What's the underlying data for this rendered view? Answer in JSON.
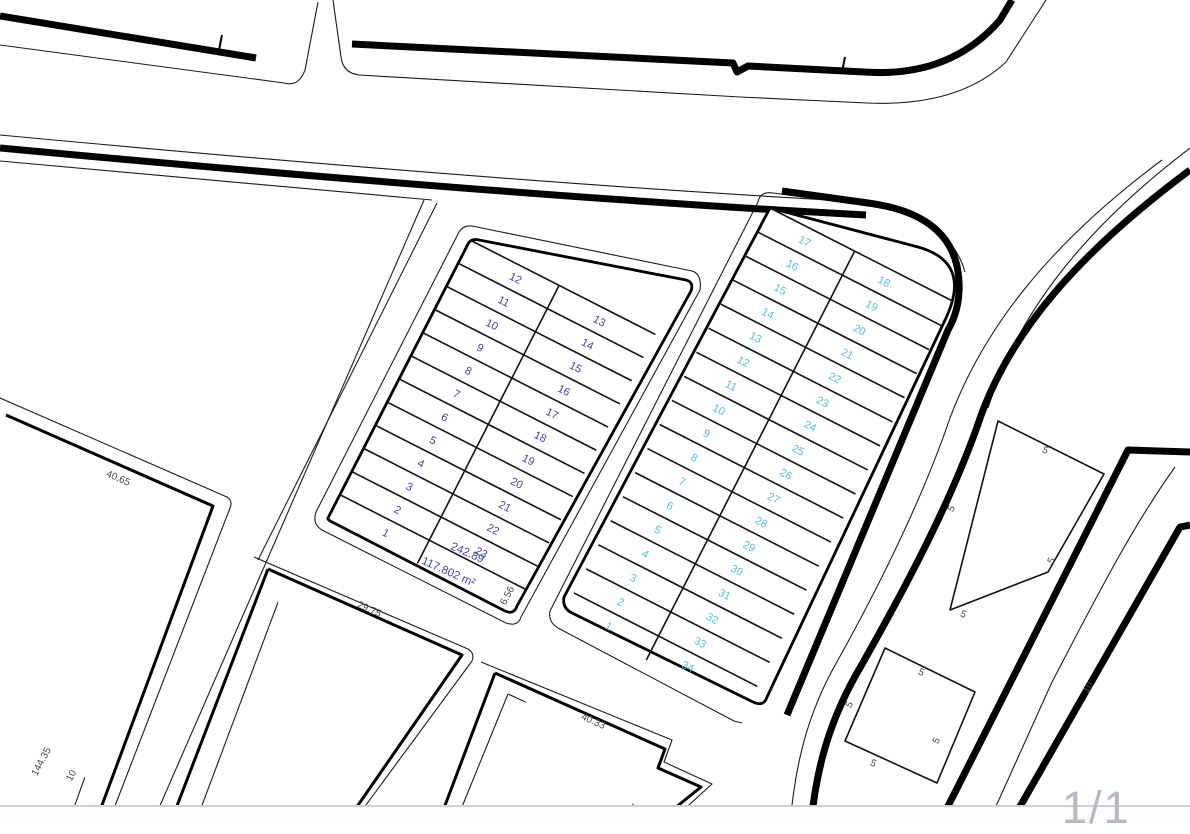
{
  "page_indicator": "1/1",
  "colors": {
    "left_parcels": "#3f43ad",
    "right_parcels": "#4cc3dc",
    "dimensions": "#4a4a4a",
    "page_indicator": "#b5bac1",
    "lines": "#000000"
  },
  "left_block": {
    "parcels": [
      "1",
      "2",
      "3",
      "4",
      "5",
      "6",
      "7",
      "8",
      "9",
      "10",
      "11",
      "12",
      "13",
      "14",
      "15",
      "16",
      "17",
      "18",
      "19",
      "20",
      "21",
      "22",
      "23"
    ],
    "dim_242": "242.89",
    "area_label": "117.802 m²"
  },
  "right_block": {
    "parcels": [
      "1",
      "2",
      "3",
      "4",
      "5",
      "6",
      "7",
      "8",
      "9",
      "10",
      "11",
      "12",
      "13",
      "14",
      "15",
      "16",
      "17",
      "18",
      "19",
      "20",
      "21",
      "22",
      "23",
      "24",
      "25",
      "26",
      "27",
      "28",
      "29",
      "30",
      "31",
      "32",
      "33",
      "34"
    ]
  },
  "dimensions": {
    "d40_65": "40.65",
    "d29_75": "29.75",
    "d40_33": "40.33",
    "d144_35": "144.35",
    "d10_left": "10",
    "d6_56": "6.56",
    "d10_road": "10",
    "d5_1": "5",
    "d5_2": "5",
    "d5_3": "5",
    "d5_4": "5",
    "d5_5": "5",
    "d5_6": "5",
    "d5_7": "5",
    "d5_8": "5"
  }
}
